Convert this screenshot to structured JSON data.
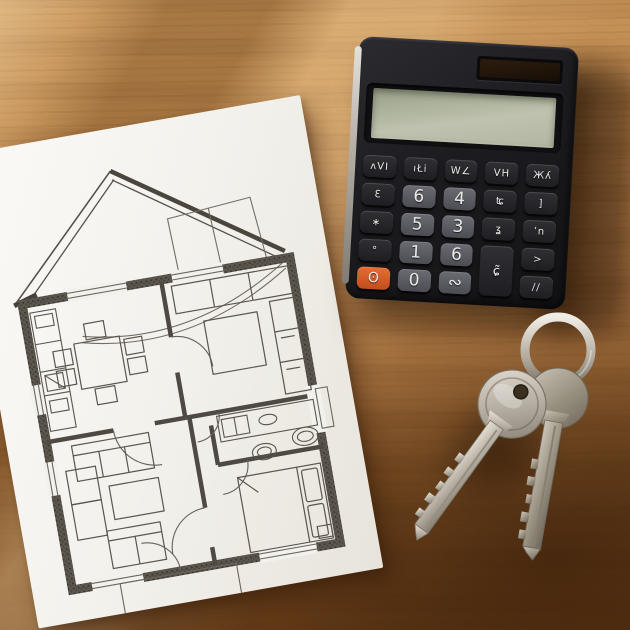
{
  "scene": {
    "description": "Photograph of a house floor plan on white paper, a black calculator and two keys on a ring, lying on a wooden table",
    "objects": [
      "wooden-table",
      "floor-plan-paper",
      "calculator",
      "keys-with-ring"
    ]
  },
  "colors": {
    "wood_light": "#c9975d",
    "wood_dark": "#70431a",
    "paper": "#f3f1ec",
    "plan_ink": "#55504a",
    "plan_wall": "#4c473f",
    "calculator_body": "#1c1c20",
    "lcd_screen": "#bec2ae",
    "solar_panel": "#2e1d0f",
    "button_dark": "#26262a",
    "button_light": "#5c5c63",
    "button_orange": "#d85f2b",
    "key_metal": "#b9b3a7"
  },
  "calculator": {
    "display_value": "",
    "keys": [
      "ᴧVI",
      "ıŁi",
      "W∠",
      "VH",
      "Жʎ",
      "Ɛ",
      "6",
      "4",
      "ʨ",
      "]",
      "∗",
      "5",
      "3",
      "ʓ",
      "ʼn",
      "°",
      "1",
      "6",
      "ɕ̃",
      ">",
      "ʘ",
      "0",
      "∾",
      "∕∕"
    ]
  }
}
